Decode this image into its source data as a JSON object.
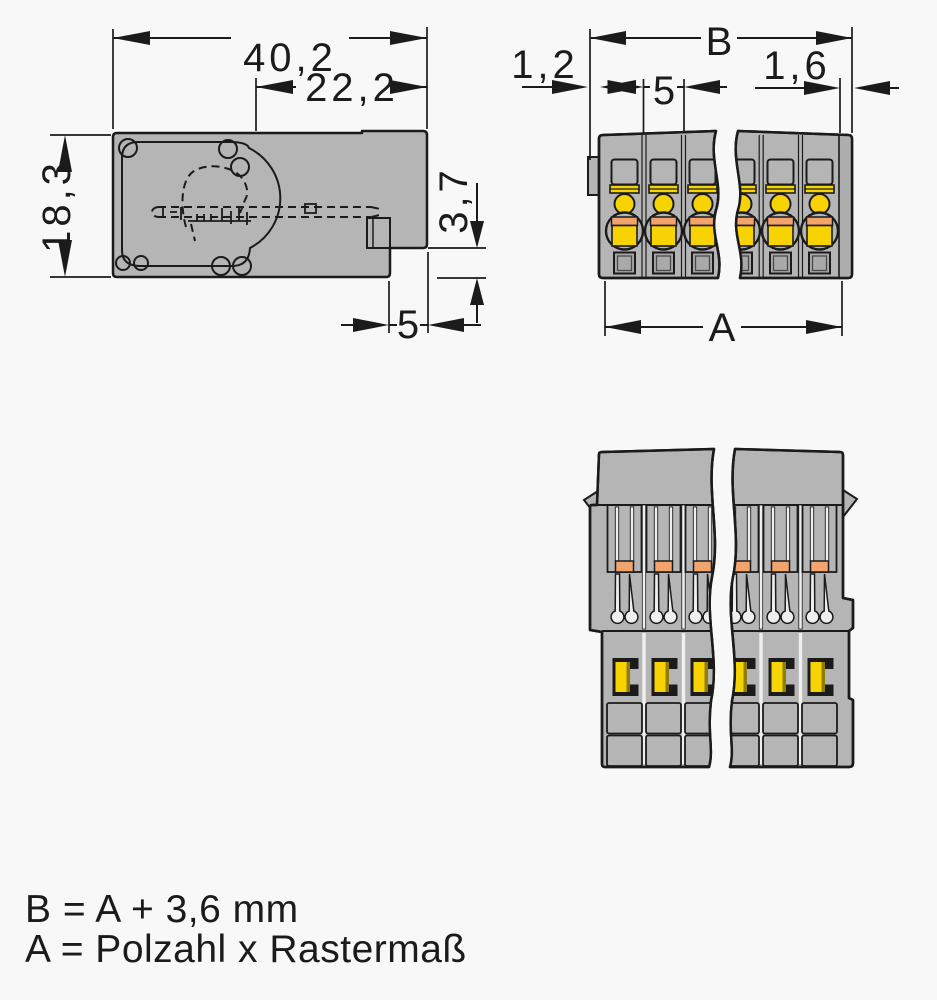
{
  "side_view": {
    "dim_total_width": "40,2",
    "dim_right_section_width": "22,2",
    "dim_height": "18,3",
    "dim_step_height": "3,7",
    "dim_step_width": "5"
  },
  "front_view": {
    "dim_overall_width": "B",
    "dim_left_offset": "1,2",
    "dim_pole_pitch": "5",
    "dim_right_offset": "1,6",
    "dim_pole_span": "A"
  },
  "legend": {
    "line1": "B = A + 3,6 mm",
    "line2": "A = Polzahl x Rastermaß"
  },
  "colors": {
    "background": "#f8f8f8",
    "body-gray": "#b5b5b5",
    "dark-gray": "#a9a9a9",
    "wall-gray": "#aeaeae",
    "accent-yellow": "#f8d303",
    "accent-orange": "#f3a36c",
    "olive": "#8f7d08",
    "slot-white": "#efefef",
    "ink": "#1b1b1b"
  }
}
